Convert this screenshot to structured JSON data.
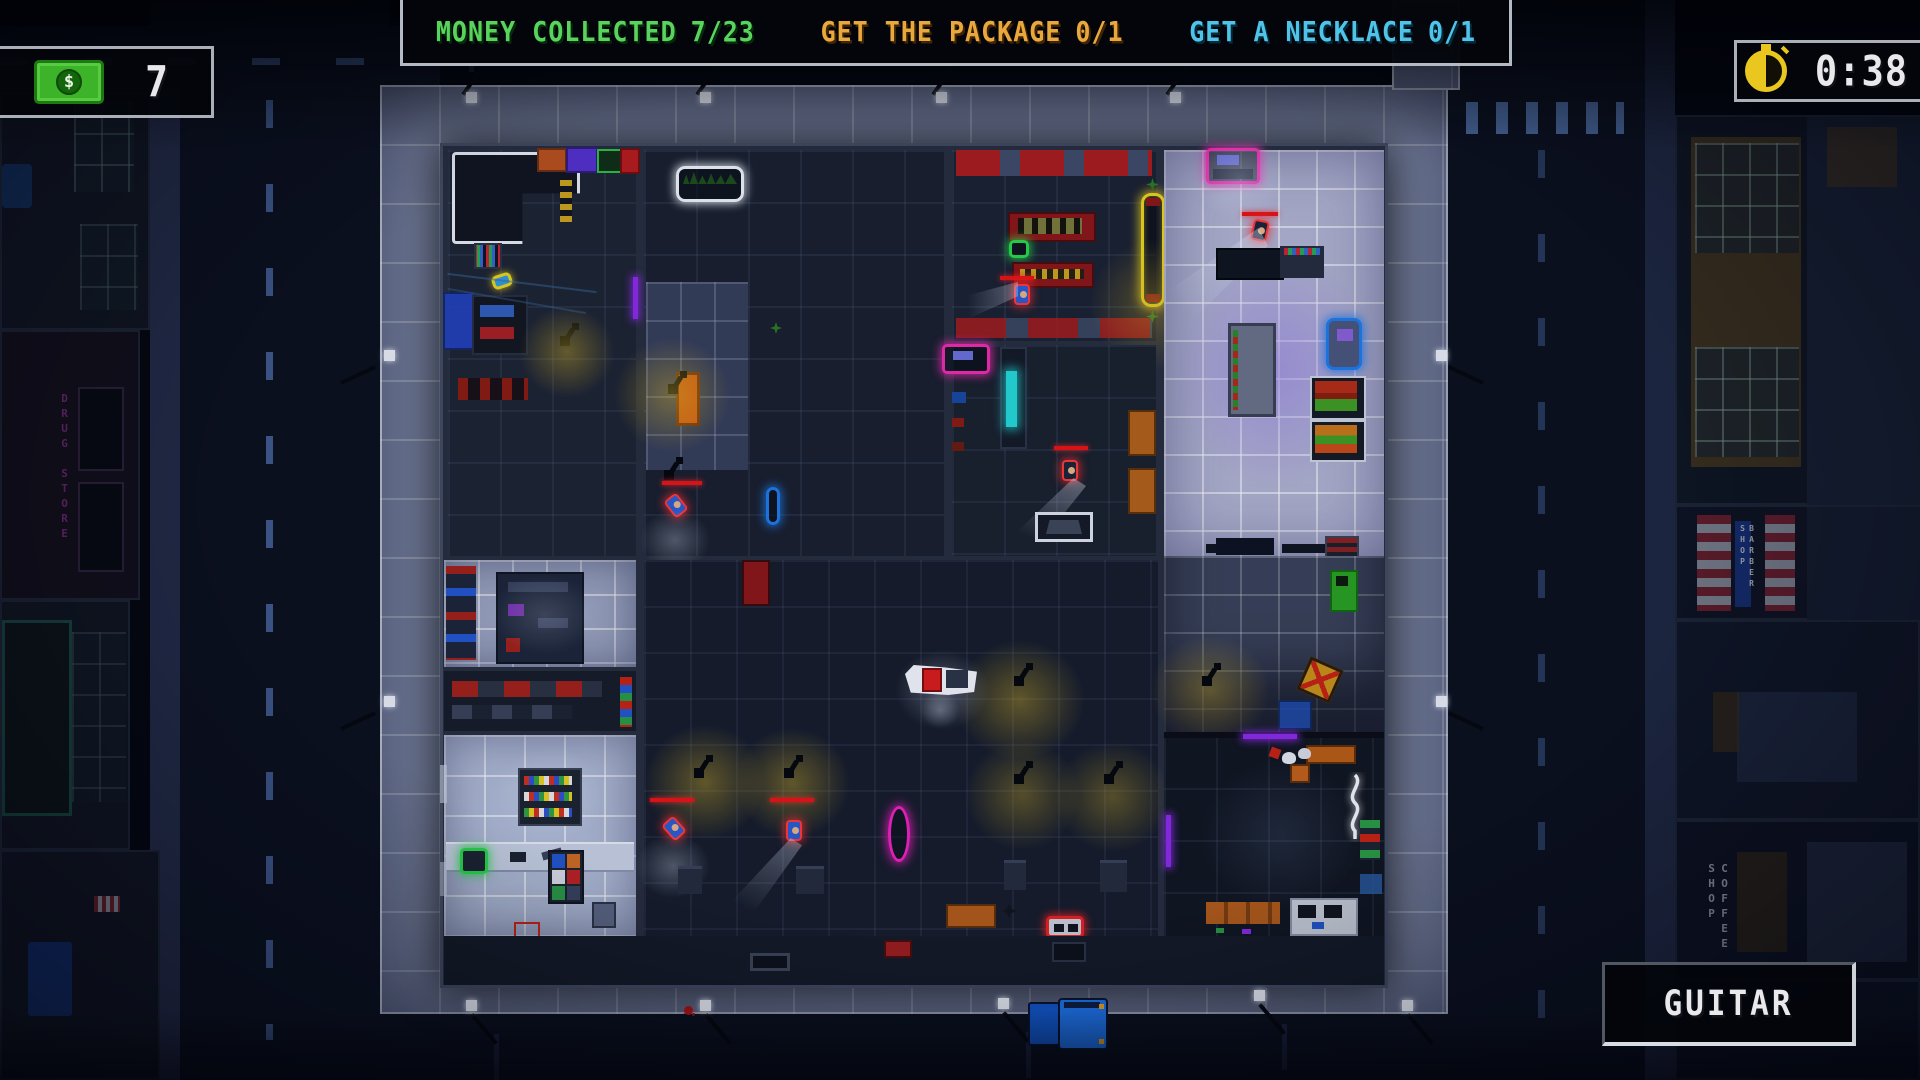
{
  "hud": {
    "objectives": [
      {
        "label": "MONEY COLLECTED",
        "count": "7/23",
        "color": "#58d35c"
      },
      {
        "label": "GET THE PACKAGE",
        "count": "0/1",
        "color": "#e9a83b"
      },
      {
        "label": "GET A NECKLACE",
        "count": "0/1",
        "color": "#4fc4e8"
      }
    ],
    "money": {
      "value": "7",
      "icon": "money-bill-icon",
      "color": "#3db32a",
      "dollar": "$"
    },
    "timer": {
      "value": "0:38",
      "icon": "stopwatch-icon",
      "color": "#e9c71f"
    },
    "held_item": {
      "label": "GUITAR"
    }
  },
  "world": {
    "signs": {
      "drug_store": "DRUG STORE",
      "coffee_shop": "COFFEE SHOP",
      "barber_shop": "BARBER SHOP"
    }
  }
}
